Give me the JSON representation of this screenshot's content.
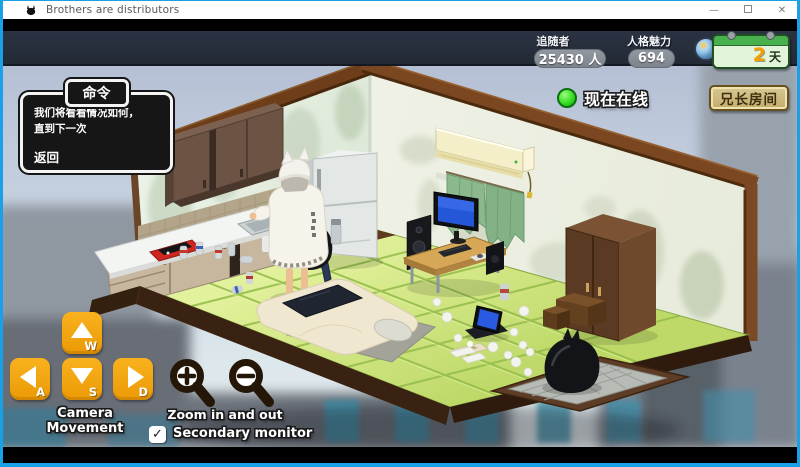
{
  "window": {
    "title": "Brothers are distributors",
    "minimize": "—",
    "close": "✕"
  },
  "hud": {
    "followers_label": "追随者",
    "followers_value": "25430 人",
    "charisma_label": "人格魅力",
    "charisma_value": "694",
    "day_value": "2",
    "day_unit": "天",
    "online_label": "现在在线",
    "room_button_label": "兄长房间"
  },
  "dialog": {
    "title": "命令",
    "body_line1": "我们将看看情况如何，",
    "body_line2": "直到下一次",
    "back_label": "返回"
  },
  "controls": {
    "camera_label": "Camera Movement",
    "key_up": "W",
    "key_left": "A",
    "key_down": "S",
    "key_right": "D",
    "zoom_label": "Zoom in and out",
    "secondary_monitor_label": "Secondary monitor",
    "secondary_monitor_checked": true,
    "checkmark": "✓"
  },
  "scene": {
    "items": [
      "sky",
      "city-buildings",
      "kitchen-wall",
      "side-wall",
      "wood-beams",
      "tatami-floor",
      "upper-cabinets",
      "tile-backsplash",
      "kitchen-counter",
      "kitchen-sink",
      "faucet",
      "red-console",
      "drink-cans",
      "refrigerator",
      "backpack",
      "trash-bag",
      "umbrella",
      "spray-can",
      "streamer-character",
      "air-conditioner",
      "noren-curtain",
      "computer-desk",
      "desktop-monitor",
      "speakers",
      "keyboard",
      "wardrobe",
      "cardboard-boxes",
      "futon",
      "blanket",
      "pillow",
      "floor-mat",
      "floor-laptop",
      "tissue-box",
      "scattered-papers",
      "entrance-step",
      "entrance-mat",
      "entrance-trash-bag"
    ]
  },
  "colors": {
    "frame_blue": "#18a0e8",
    "hud_bar": "#272e3b",
    "pill_gray": "#878c94",
    "calendar_green": "#48b04c",
    "day_orange": "#f79f00",
    "online_green": "#35e02a",
    "room_button_tan": "#cdb97e",
    "control_orange": "#f2a40b",
    "dialog_bg": "#161616",
    "tatami_green": "#cde47b",
    "sky_blue": "#c3d0de"
  }
}
